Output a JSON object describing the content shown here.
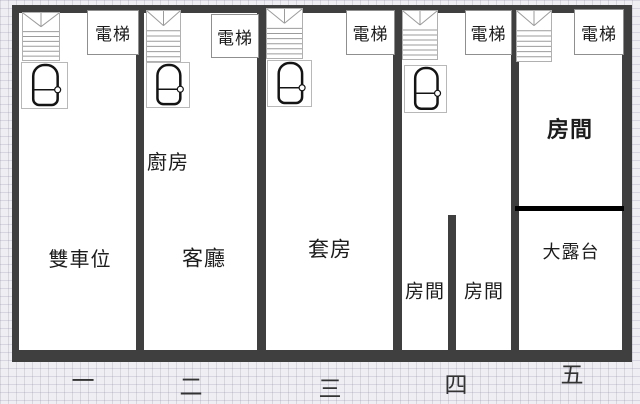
{
  "colors": {
    "background": "#efeef3",
    "grid_line": "#7d7d9e",
    "wall": "#3f3f3f",
    "terrace_divider": "#000000",
    "plan_fill": "#ffffff",
    "icon_outline": "#b0b0b0",
    "stair_line": "#9b9b9b",
    "tub_stroke": "#141414",
    "elevator_border": "#8f8f8f",
    "label_text": "#1c1c1c",
    "floor_text": "#333333"
  },
  "plan": {
    "x": 12,
    "y": 5,
    "w": 620,
    "h": 357
  },
  "walls": [
    {
      "name": "outer-wall-top",
      "x": 12,
      "y": 5,
      "w": 620,
      "h": 8
    },
    {
      "name": "outer-wall-bottom",
      "x": 12,
      "y": 350,
      "w": 620,
      "h": 12
    },
    {
      "name": "outer-wall-left",
      "x": 12,
      "y": 5,
      "w": 7,
      "h": 357
    },
    {
      "name": "outer-wall-right",
      "x": 622,
      "y": 5,
      "w": 10,
      "h": 357
    },
    {
      "name": "unit-wall-2",
      "x": 136,
      "y": 13,
      "w": 8,
      "h": 337
    },
    {
      "name": "unit-wall-3",
      "x": 257,
      "y": 13,
      "w": 9,
      "h": 337
    },
    {
      "name": "unit-wall-4",
      "x": 393,
      "y": 13,
      "w": 9,
      "h": 337
    },
    {
      "name": "unit-wall-5",
      "x": 511,
      "y": 13,
      "w": 8,
      "h": 337
    },
    {
      "name": "room-divider-unit-4",
      "x": 448,
      "y": 215,
      "w": 8,
      "h": 135
    },
    {
      "name": "terrace-divider-unit-5",
      "x": 515,
      "y": 206,
      "w": 109,
      "h": 5,
      "color": "#000000"
    }
  ],
  "units": [
    {
      "floor": {
        "label": "一",
        "x": 83,
        "y": 381
      },
      "elevator": {
        "label": "電梯",
        "x": 87,
        "y": 10,
        "w": 50,
        "h": 43
      },
      "stairs": {
        "x": 22,
        "y": 12,
        "w": 38,
        "h": 49
      },
      "bath": {
        "x": 21,
        "y": 62,
        "w": 47,
        "h": 47
      },
      "rooms": [
        {
          "label": "雙車位",
          "x": 80,
          "y": 260,
          "size": 20,
          "bold": false
        }
      ]
    },
    {
      "floor": {
        "label": "二",
        "x": 191,
        "y": 387
      },
      "elevator": {
        "label": "電梯",
        "x": 211,
        "y": 14,
        "w": 46,
        "h": 42
      },
      "stairs": {
        "x": 146,
        "y": 10,
        "w": 35,
        "h": 52
      },
      "bath": {
        "x": 146,
        "y": 62,
        "w": 44,
        "h": 46
      },
      "rooms": [
        {
          "label": "廚房",
          "x": 168,
          "y": 163,
          "size": 20,
          "bold": false
        },
        {
          "label": "客廳",
          "x": 204,
          "y": 259,
          "size": 21,
          "bold": false
        }
      ]
    },
    {
      "floor": {
        "label": "三",
        "x": 330,
        "y": 389
      },
      "elevator": {
        "label": "電梯",
        "x": 346,
        "y": 10,
        "w": 47,
        "h": 43
      },
      "stairs": {
        "x": 266,
        "y": 8,
        "w": 37,
        "h": 51
      },
      "bath": {
        "x": 267,
        "y": 60,
        "w": 45,
        "h": 47
      },
      "rooms": [
        {
          "label": "套房",
          "x": 330,
          "y": 250,
          "size": 21,
          "bold": false
        }
      ]
    },
    {
      "floor": {
        "label": "四",
        "x": 456,
        "y": 385
      },
      "elevator": {
        "label": "電梯",
        "x": 465,
        "y": 10,
        "w": 45,
        "h": 43
      },
      "stairs": {
        "x": 402,
        "y": 10,
        "w": 36,
        "h": 50
      },
      "bath": {
        "x": 404,
        "y": 65,
        "w": 43,
        "h": 48
      },
      "rooms": [
        {
          "label": "房間",
          "x": 425,
          "y": 292,
          "size": 19,
          "bold": false
        },
        {
          "label": "房間",
          "x": 484,
          "y": 292,
          "size": 19,
          "bold": false
        }
      ]
    },
    {
      "floor": {
        "label": "五",
        "x": 572,
        "y": 375
      },
      "elevator": {
        "label": "電梯",
        "x": 574,
        "y": 9,
        "w": 48,
        "h": 44
      },
      "stairs": {
        "x": 516,
        "y": 10,
        "w": 36,
        "h": 52
      },
      "bath": null,
      "rooms": [
        {
          "label": "房間",
          "x": 570,
          "y": 130,
          "size": 22,
          "bold": true
        },
        {
          "label": "大露台",
          "x": 571,
          "y": 252,
          "size": 18,
          "bold": false
        }
      ]
    }
  ]
}
